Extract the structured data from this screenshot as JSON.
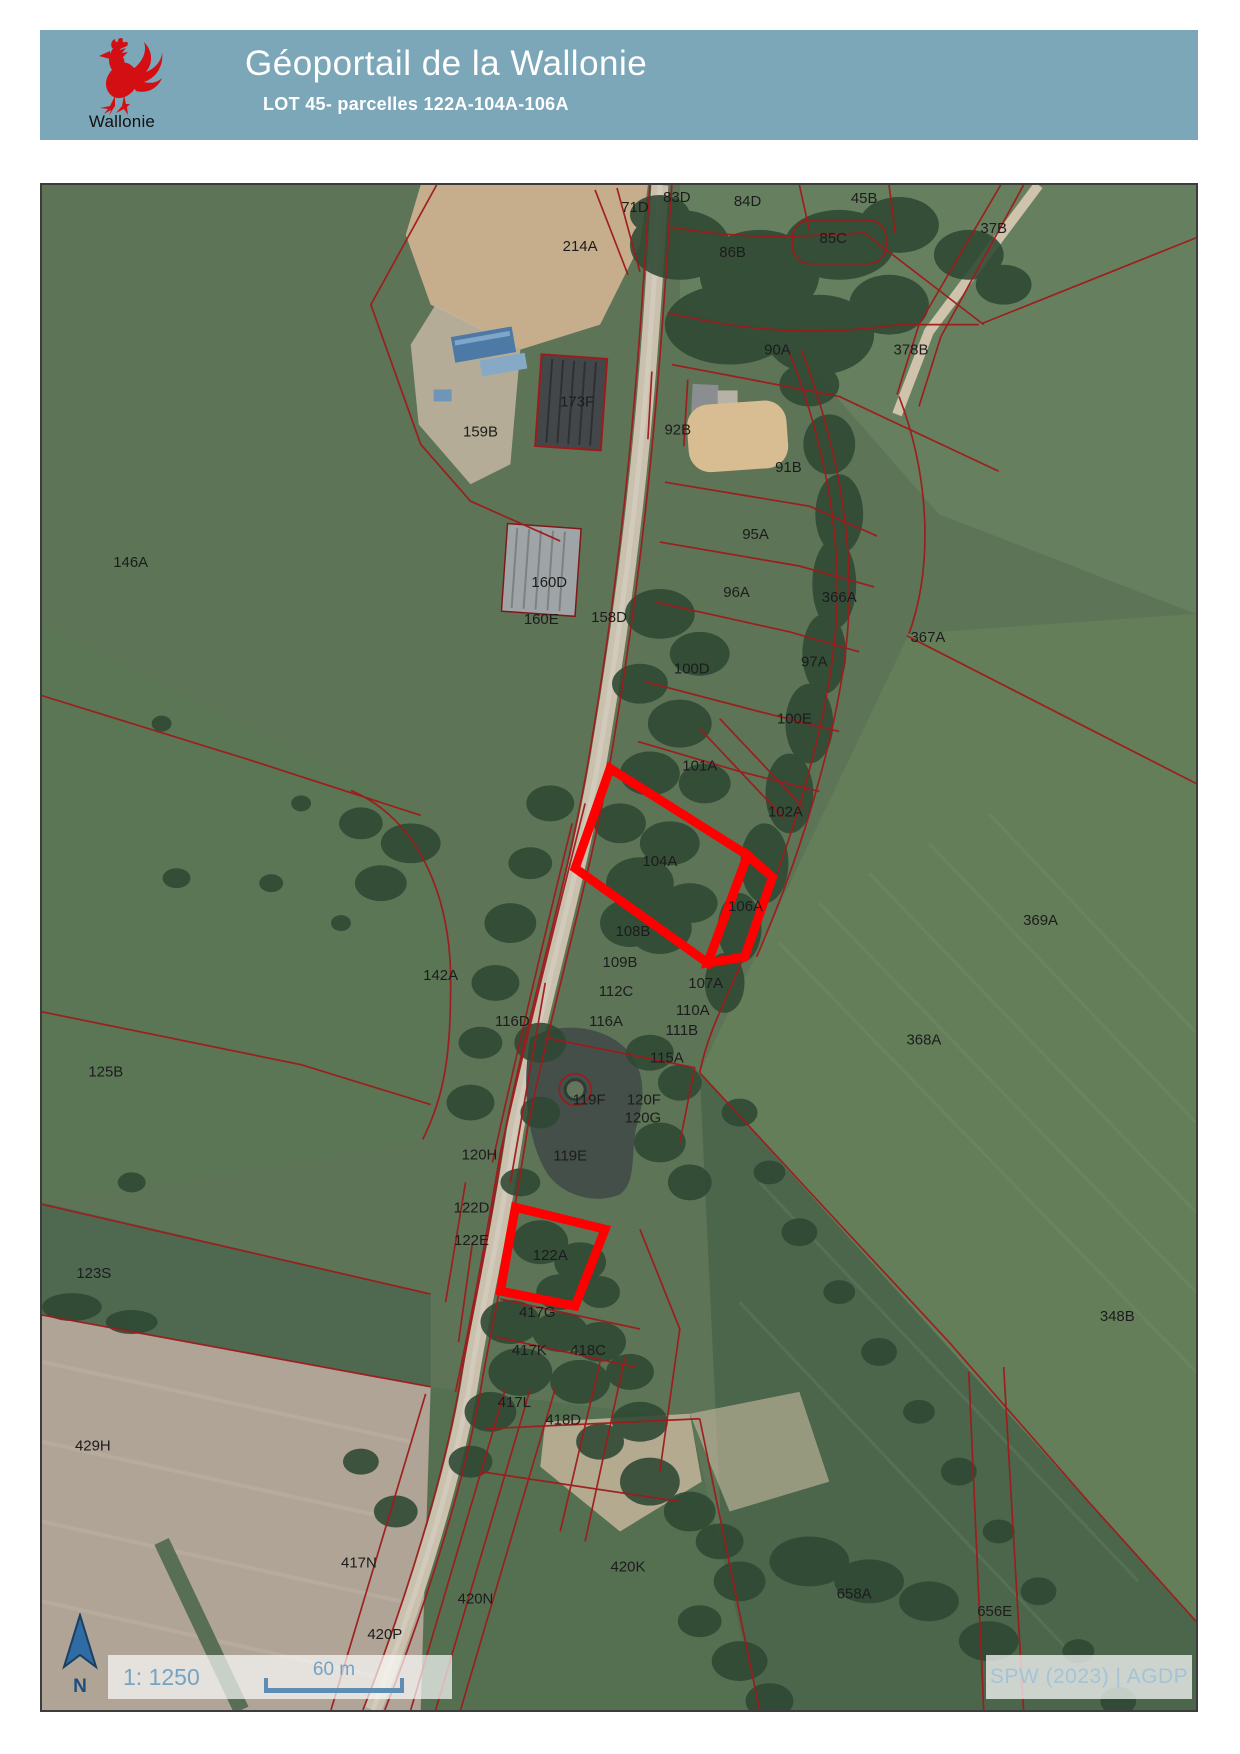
{
  "header": {
    "title": "Géoportail de la Wallonie",
    "subtitle": "LOT 45- parcelles 122A-104A-106A",
    "logo_text": "Wallonie"
  },
  "map": {
    "scale_text": "1: 1250",
    "scale_bar_label": "60 m",
    "north_label": "N",
    "attribution": "SPW (2023) | AGDP",
    "parcel_labels": [
      {
        "text": "71D",
        "x": 595,
        "y": 27
      },
      {
        "text": "83D",
        "x": 637,
        "y": 17
      },
      {
        "text": "84D",
        "x": 708,
        "y": 21
      },
      {
        "text": "45B",
        "x": 825,
        "y": 18
      },
      {
        "text": "37B",
        "x": 955,
        "y": 48
      },
      {
        "text": "214A",
        "x": 540,
        "y": 66
      },
      {
        "text": "86B",
        "x": 693,
        "y": 72
      },
      {
        "text": "85C",
        "x": 794,
        "y": 58
      },
      {
        "text": "90A",
        "x": 738,
        "y": 170
      },
      {
        "text": "378B",
        "x": 872,
        "y": 170
      },
      {
        "text": "173F",
        "x": 537,
        "y": 222
      },
      {
        "text": "159B",
        "x": 440,
        "y": 252
      },
      {
        "text": "92B",
        "x": 638,
        "y": 250
      },
      {
        "text": "91B",
        "x": 749,
        "y": 288
      },
      {
        "text": "95A",
        "x": 716,
        "y": 355
      },
      {
        "text": "146A",
        "x": 89,
        "y": 383
      },
      {
        "text": "160D",
        "x": 509,
        "y": 403
      },
      {
        "text": "96A",
        "x": 697,
        "y": 413
      },
      {
        "text": "366A",
        "x": 800,
        "y": 418
      },
      {
        "text": "160E",
        "x": 501,
        "y": 440
      },
      {
        "text": "158D",
        "x": 569,
        "y": 438
      },
      {
        "text": "367A",
        "x": 889,
        "y": 458
      },
      {
        "text": "97A",
        "x": 775,
        "y": 483
      },
      {
        "text": "100D",
        "x": 652,
        "y": 490
      },
      {
        "text": "100E",
        "x": 755,
        "y": 540
      },
      {
        "text": "101A",
        "x": 660,
        "y": 587
      },
      {
        "text": "102A",
        "x": 746,
        "y": 633
      },
      {
        "text": "104A",
        "x": 620,
        "y": 683
      },
      {
        "text": "106A",
        "x": 706,
        "y": 728
      },
      {
        "text": "108B",
        "x": 593,
        "y": 753
      },
      {
        "text": "109B",
        "x": 580,
        "y": 784
      },
      {
        "text": "142A",
        "x": 400,
        "y": 797
      },
      {
        "text": "107A",
        "x": 666,
        "y": 805
      },
      {
        "text": "112C",
        "x": 576,
        "y": 813
      },
      {
        "text": "110A",
        "x": 653,
        "y": 832
      },
      {
        "text": "116D",
        "x": 472,
        "y": 843
      },
      {
        "text": "116A",
        "x": 566,
        "y": 843
      },
      {
        "text": "111B",
        "x": 642,
        "y": 852
      },
      {
        "text": "369A",
        "x": 1002,
        "y": 742
      },
      {
        "text": "368A",
        "x": 885,
        "y": 862
      },
      {
        "text": "115A",
        "x": 627,
        "y": 880
      },
      {
        "text": "125B",
        "x": 64,
        "y": 894
      },
      {
        "text": "119F",
        "x": 549,
        "y": 922
      },
      {
        "text": "120F",
        "x": 604,
        "y": 922
      },
      {
        "text": "120G",
        "x": 603,
        "y": 940
      },
      {
        "text": "120H",
        "x": 439,
        "y": 977
      },
      {
        "text": "119E",
        "x": 530,
        "y": 978
      },
      {
        "text": "122D",
        "x": 431,
        "y": 1030
      },
      {
        "text": "122E",
        "x": 431,
        "y": 1063
      },
      {
        "text": "122A",
        "x": 510,
        "y": 1078
      },
      {
        "text": "123S",
        "x": 52,
        "y": 1096
      },
      {
        "text": "417G",
        "x": 497,
        "y": 1135
      },
      {
        "text": "348B",
        "x": 1079,
        "y": 1139
      },
      {
        "text": "417K",
        "x": 489,
        "y": 1173
      },
      {
        "text": "418C",
        "x": 548,
        "y": 1173
      },
      {
        "text": "417L",
        "x": 474,
        "y": 1225
      },
      {
        "text": "418D",
        "x": 523,
        "y": 1243
      },
      {
        "text": "429H",
        "x": 51,
        "y": 1269
      },
      {
        "text": "417N",
        "x": 318,
        "y": 1386
      },
      {
        "text": "420K",
        "x": 588,
        "y": 1390
      },
      {
        "text": "420N",
        "x": 435,
        "y": 1422
      },
      {
        "text": "658A",
        "x": 815,
        "y": 1417
      },
      {
        "text": "420P",
        "x": 344,
        "y": 1458
      },
      {
        "text": "656E",
        "x": 956,
        "y": 1435
      }
    ],
    "highlighted_parcels": [
      {
        "name": "104A",
        "points": "570,585 708,672 668,780 535,685"
      },
      {
        "name": "106A",
        "points": "708,672 733,694 705,774 668,780"
      },
      {
        "name": "122A",
        "points": "475,1025 565,1047 535,1124 460,1109"
      }
    ]
  },
  "colors": {
    "header_bg": "#7ca7b9",
    "highlight": "#ff0000",
    "parcel_line": "#9e1b1b",
    "rooster_red": "#d40f14",
    "scale_text": "#74a3c4"
  }
}
